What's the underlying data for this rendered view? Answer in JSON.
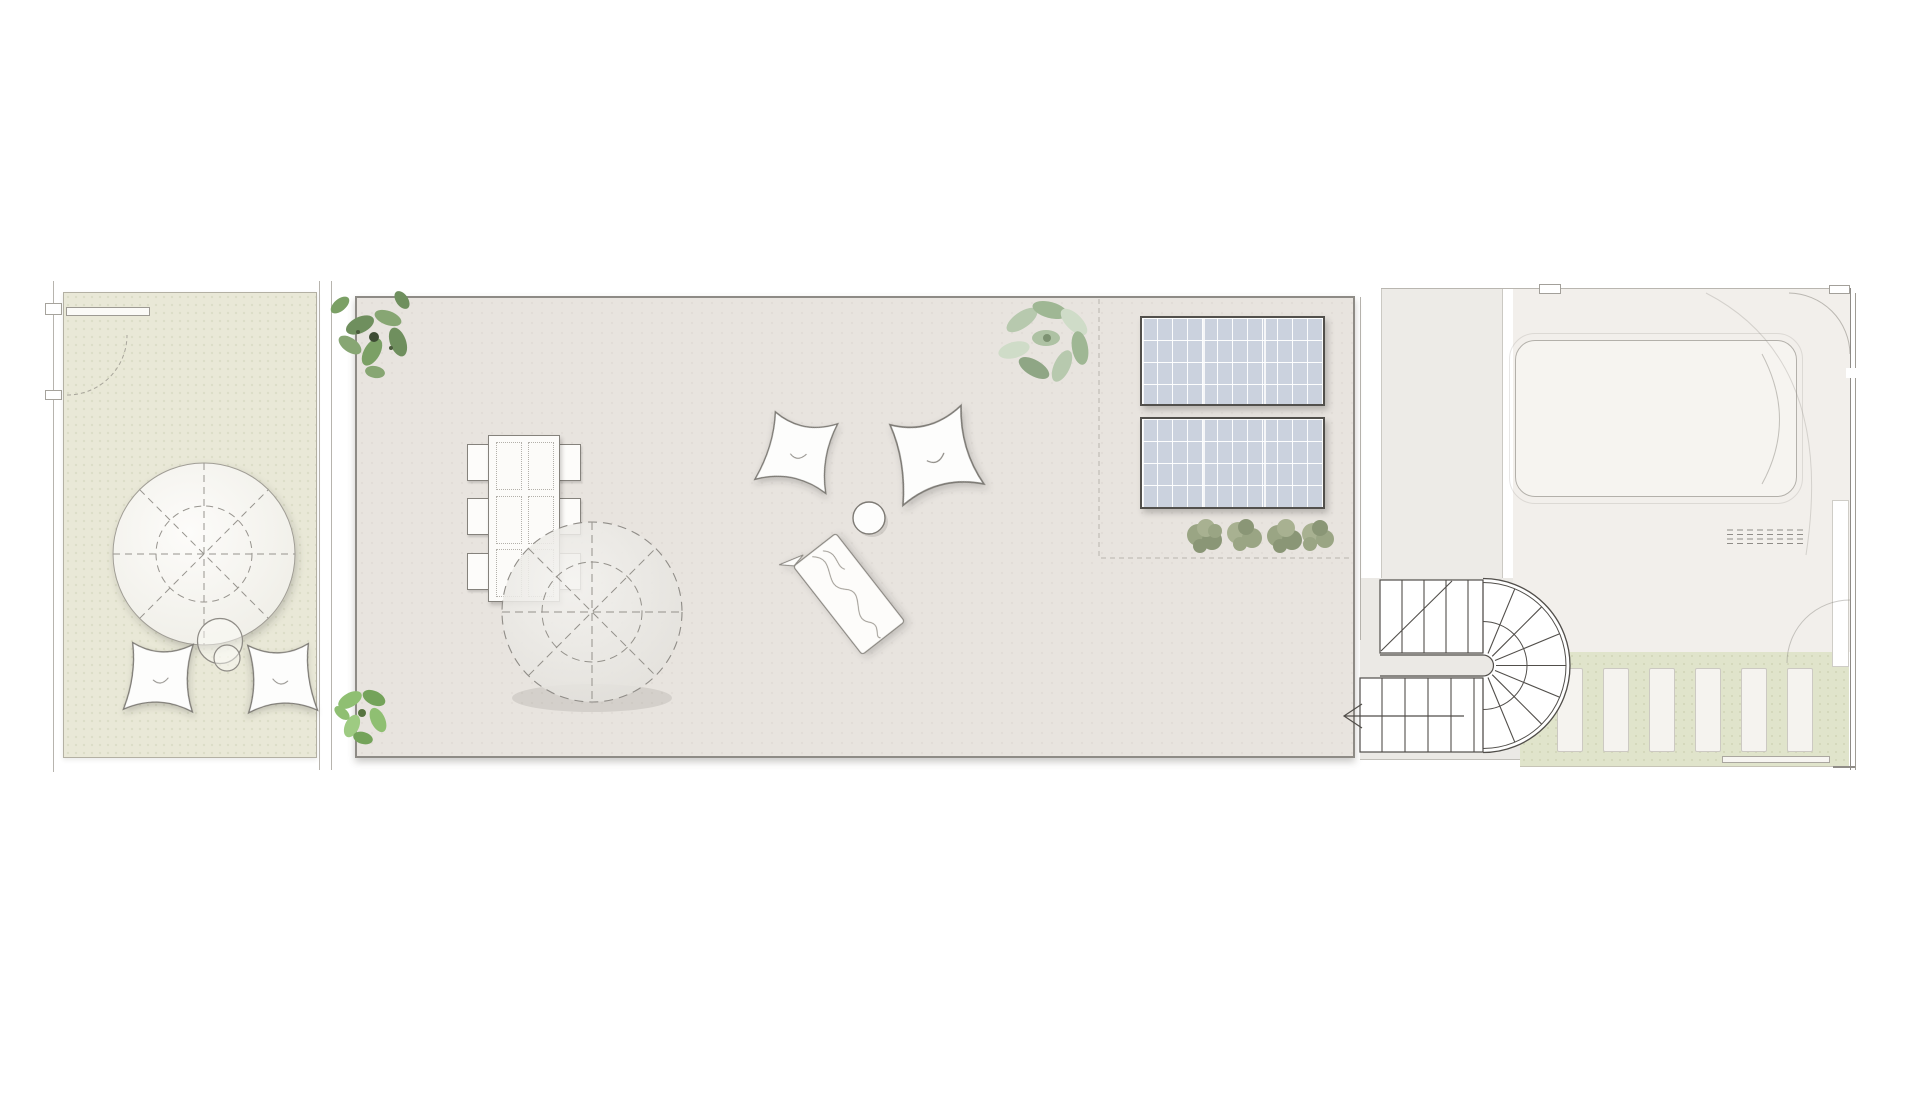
{
  "meta": {
    "drawing_kind": "roof terrace floor plan",
    "visible_text": ""
  },
  "colors": {
    "page_bg": "#ffffff",
    "garden_fill": "#e9e8d7",
    "garden_border": "#b3b0a3",
    "terrace_fill": "#e8e4df",
    "terrace_border": "#8e8b86",
    "landing_fill": "#edebe7",
    "stairzone_fill": "#ebe9e5",
    "roof_fill": "#f2efeb",
    "pergola_fill": "#e0e4cb",
    "slat_fill": "#f5f3ef",
    "panel_fill": "#cbd2de",
    "panel_border": "#52504c",
    "line": "#8f8c87",
    "thin_line": "#b7b4ae",
    "furniture_fill": "#fdfcfa",
    "furniture_outline": "#85827c",
    "stair_line": "#514e4a",
    "plant_dark": "#6f8f5e",
    "plant_dark2": "#87a673",
    "plant_sage": "#b7c9ae",
    "plant_sage2": "#9fb794",
    "plant_bright": "#8fbf72",
    "plant_bright2": "#74a35a",
    "shrub_olive": "#9aa584",
    "shrub_olive2": "#8a9676"
  },
  "inventory": {
    "garden_patio": {
      "parasol": 1,
      "butterfly_chairs": 2,
      "side_tables": 2,
      "planter": 1,
      "door_swing": 1
    },
    "main_terrace": {
      "dining_table": 1,
      "dining_chairs": 6,
      "parasol": 1,
      "butterfly_chairs": 2,
      "coffee_table": 1,
      "sun_lounger": 1,
      "solar_panels": 2,
      "shrubs": 4,
      "plants": 3
    },
    "access": {
      "half_turn_stair": 1,
      "direction_arrow": 1
    },
    "front_roof": {
      "rooflight_canopy": 1,
      "vent_grille": 1,
      "pergola_slats": 6
    }
  }
}
